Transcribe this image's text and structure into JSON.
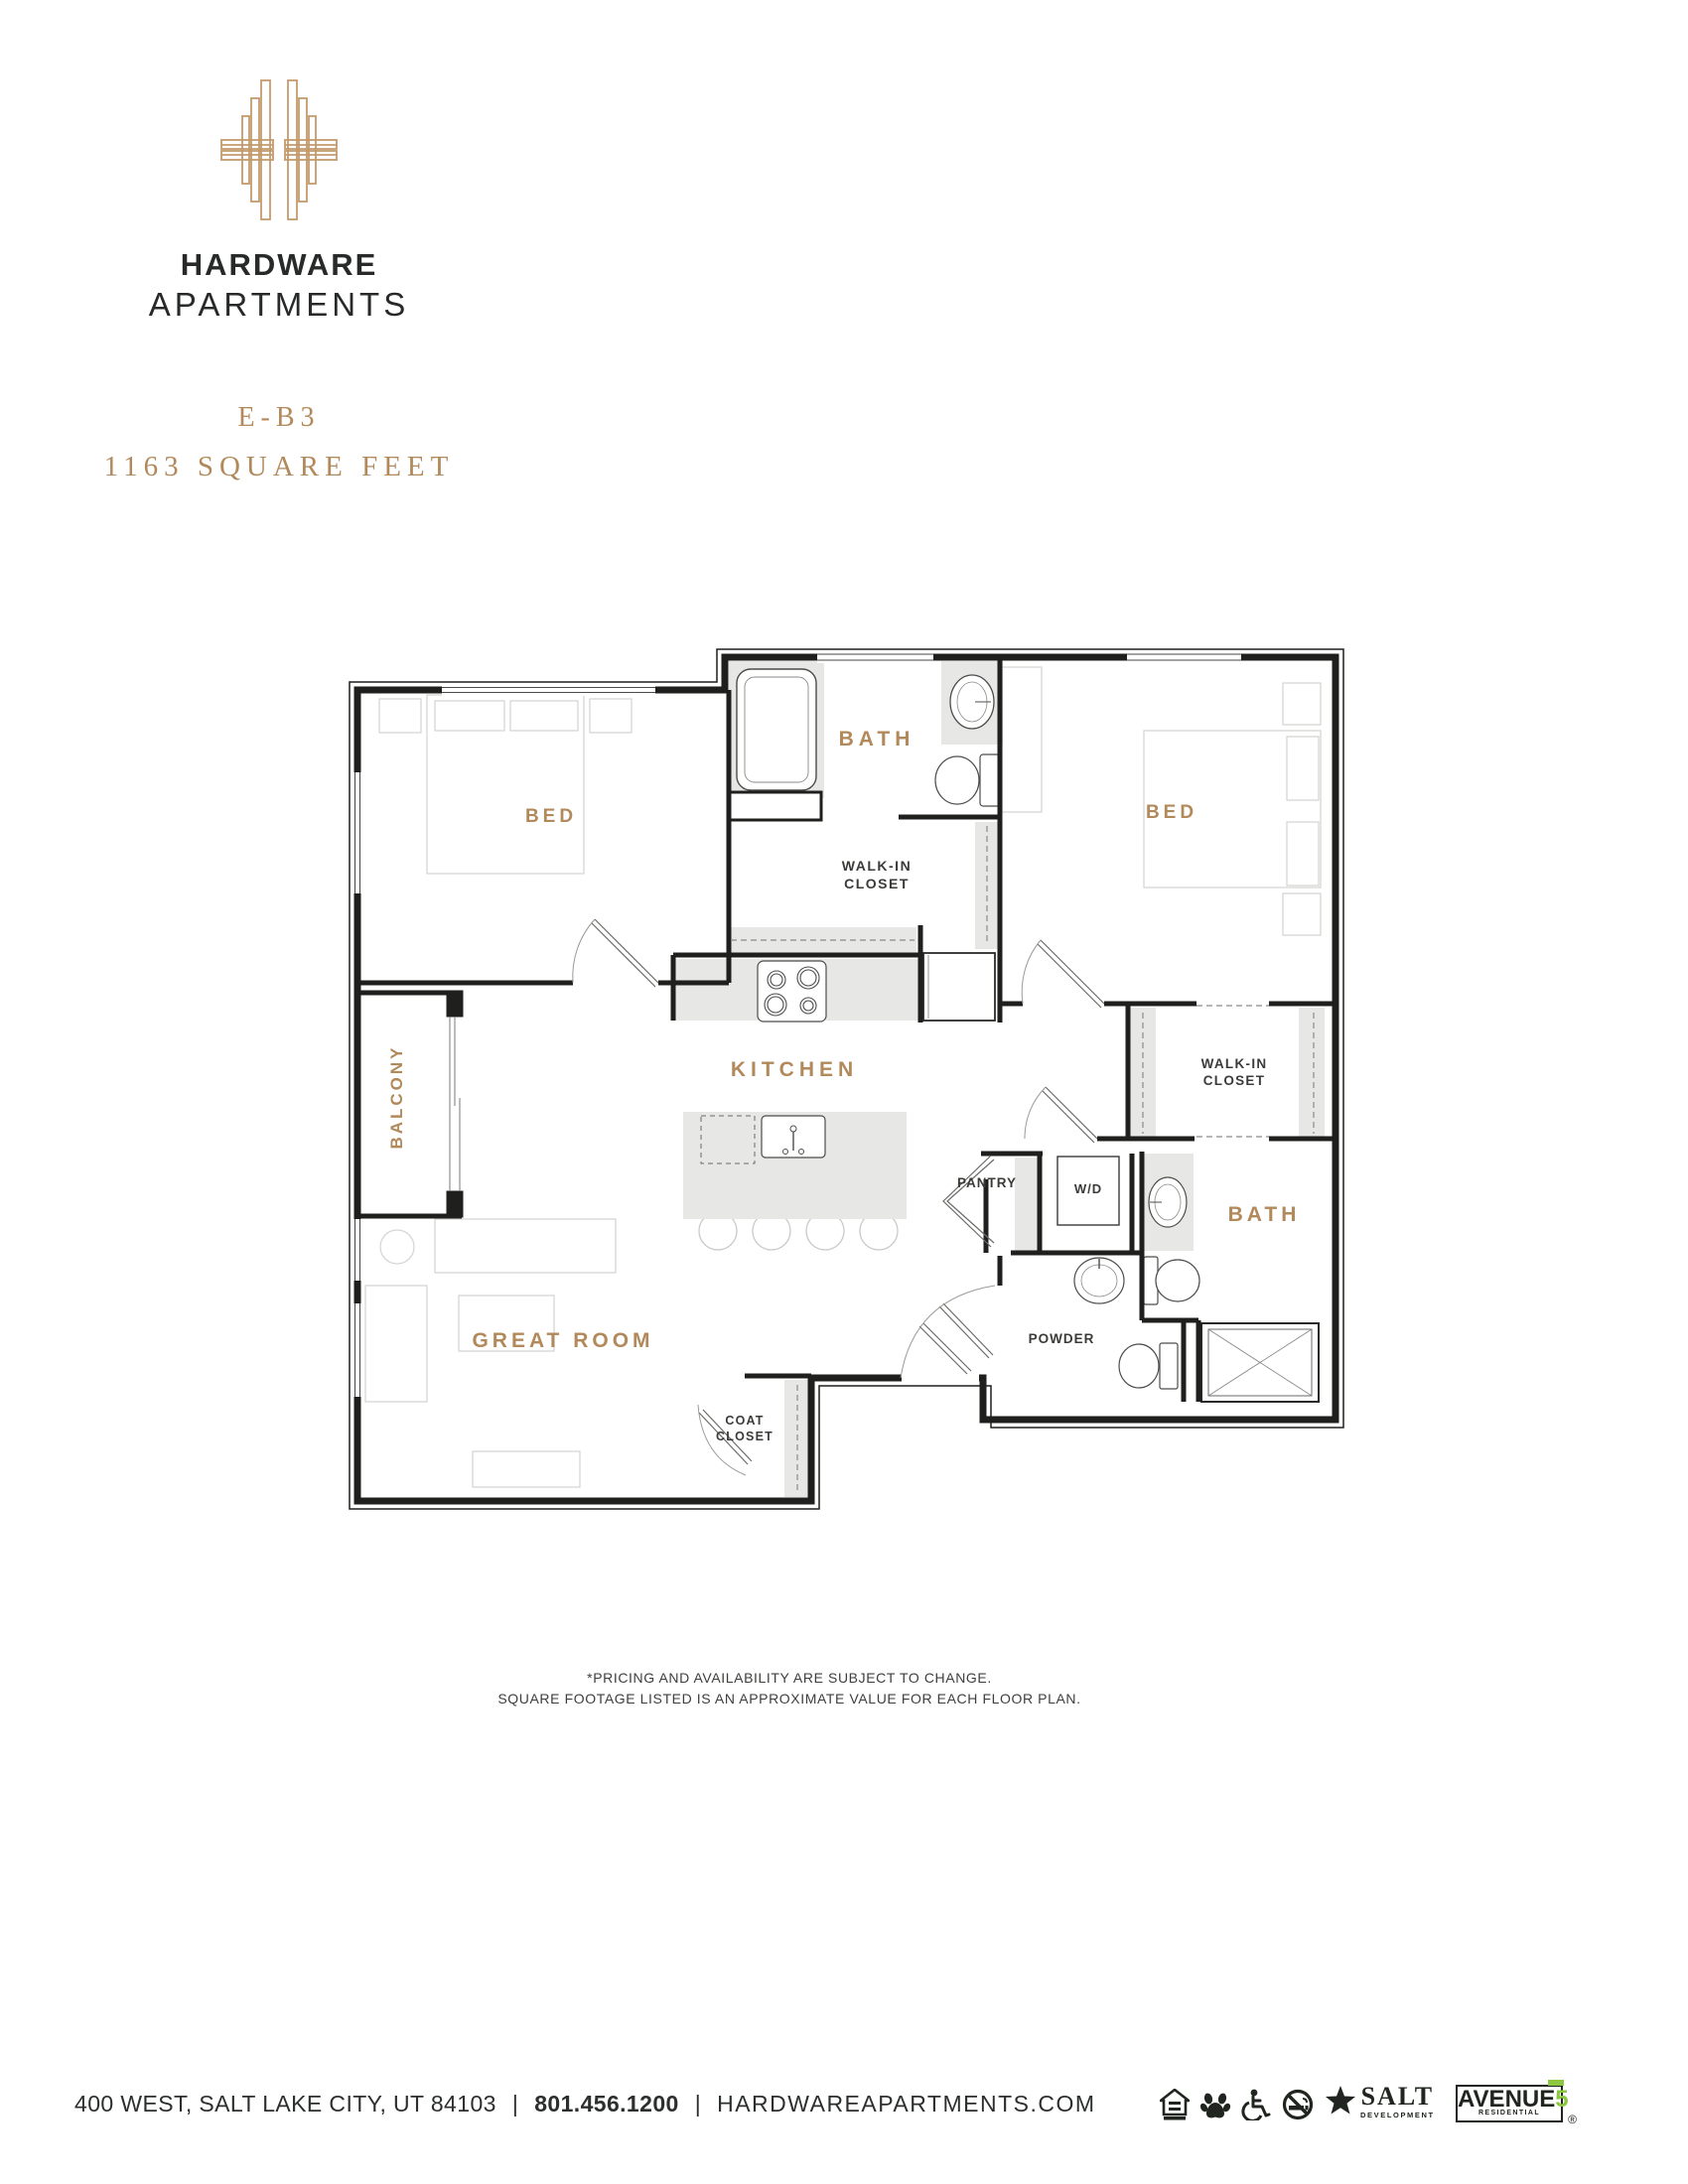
{
  "brand": {
    "name_line1": "HARDWARE",
    "name_line2": "APARTMENTS",
    "logo_icon": "art-deco-h-monogram",
    "logo_color": "#c49a6c",
    "text_color": "#272a29"
  },
  "plan_header": {
    "unit": "E-B3",
    "size": "1163 SQUARE FEET",
    "accent_color": "#b2895a"
  },
  "floor_plan": {
    "labels": {
      "bed_left": "BED",
      "bath_top": "BATH",
      "walkin_top_1": "WALK-IN",
      "walkin_top_2": "CLOSET",
      "bed_right": "BED",
      "balcony": "BALCONY",
      "kitchen": "KITCHEN",
      "pantry": "PANTRY",
      "washer_dryer": "W/D",
      "walkin_right_1": "WALK-IN",
      "walkin_right_2": "CLOSET",
      "bath_right": "BATH",
      "powder": "POWDER",
      "great_room": "GREAT ROOM",
      "coat_closet_1": "COAT",
      "coat_closet_2": "CLOSET"
    },
    "colors": {
      "wall": "#1f1f1d",
      "accent_label": "#b2895a",
      "dark_label": "#3b3b39",
      "gray_fill": "#e7e7e5",
      "furniture_outline": "#d6d6d2"
    }
  },
  "disclaimer": {
    "line1": "*PRICING AND AVAILABILITY ARE SUBJECT TO CHANGE.",
    "line2": "SQUARE FOOTAGE LISTED IS AN APPROXIMATE VALUE FOR EACH FLOOR PLAN."
  },
  "footer": {
    "address": "400 WEST, SALT LAKE CITY, UT 84103",
    "separator1": "|",
    "phone": "801.456.1200",
    "separator2": "|",
    "website": "HARDWAREAPARTMENTS.COM",
    "icons": [
      {
        "name": "equal-housing-opportunity-icon"
      },
      {
        "name": "pet-friendly-paw-icon"
      },
      {
        "name": "wheelchair-accessible-icon"
      },
      {
        "name": "no-smoking-icon"
      }
    ],
    "salt_logo": {
      "star": "★",
      "line1": "SALT",
      "line2": "DEVELOPMENT"
    },
    "avenue5_logo": {
      "name": "AVENUE",
      "five": "5",
      "sub": "RESIDENTIAL",
      "reg": "®",
      "green": "#8dc63f"
    }
  }
}
